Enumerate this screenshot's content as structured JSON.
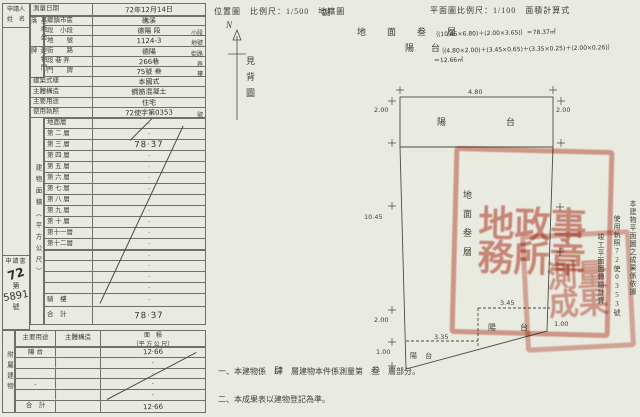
{
  "applicant": {
    "line1": "申請人",
    "line2": "姓　名"
  },
  "application": {
    "doc": "申請書",
    "year": "72",
    "no_prefix": "第",
    "number": "5891",
    "no_suffix": "號"
  },
  "form": {
    "survey": {
      "label": "測量日期",
      "value": "72年12月14日"
    },
    "group_labels": {
      "site": "基地坐落",
      "address": "建物門牌",
      "area": "建物面積（平方公尺）"
    },
    "rows": [
      {
        "label": "鄉鎮市區",
        "value": "礁溪",
        "suffix": ""
      },
      {
        "label": "段　小段",
        "value": "德陽 段",
        "suffix": "小段"
      },
      {
        "label": "地　　號",
        "value": "1124-3",
        "suffix": "地號"
      },
      {
        "label": "街　　路",
        "value": "德陽",
        "suffix": "街路"
      },
      {
        "label": "段 巷 弄",
        "value": "266巷",
        "suffix": "弄"
      },
      {
        "label": "門　　牌",
        "value": "75號 叁",
        "suffix": "樓"
      },
      {
        "label": "建築式樣",
        "value": "本國式",
        "suffix": ""
      },
      {
        "label": "主體構造",
        "value": "鋼筋混凝土",
        "suffix": ""
      },
      {
        "label": "主要用途",
        "value": "住宅",
        "suffix": ""
      },
      {
        "label": "使用執照",
        "value": "72使字第0353",
        "suffix": "號"
      }
    ],
    "floors": [
      {
        "label": "地面層",
        "value": "·"
      },
      {
        "label": "第 二 層",
        "value": "·"
      },
      {
        "label": "第 三 層",
        "value": "78·37",
        "em": true
      },
      {
        "label": "第 四 層",
        "value": "·"
      },
      {
        "label": "第 五 層",
        "value": "·"
      },
      {
        "label": "第 六 層",
        "value": "·"
      },
      {
        "label": "第 七 層",
        "value": "·"
      },
      {
        "label": "第 八 層",
        "value": "·"
      },
      {
        "label": "第 九 層",
        "value": "·"
      },
      {
        "label": "第 十 層",
        "value": "·"
      },
      {
        "label": "第十一層",
        "value": "·"
      },
      {
        "label": "第十二層",
        "value": "·"
      }
    ],
    "extras": [
      "·",
      "·",
      "·",
      "·"
    ],
    "qilou": {
      "label": "騎　樓",
      "value": "·"
    },
    "total": {
      "label": "合　計",
      "value": "78·37"
    }
  },
  "annex": {
    "side_label": "附屬建物",
    "headers": {
      "use": "主要用途",
      "structure": "主體構造",
      "area1": "面　積",
      "area2": "（平 方 公 尺）"
    },
    "rows": [
      {
        "use": "陽 台",
        "structure": "",
        "area": "12·66"
      },
      {
        "use": "",
        "structure": "",
        "area": "·"
      },
      {
        "use": "",
        "structure": "",
        "area": "·"
      },
      {
        "use": "-",
        "structure": "",
        "area": "·"
      },
      {
        "use": "",
        "structure": "",
        "area": "·"
      }
    ],
    "total": {
      "label": "合　計",
      "value": "12·66"
    }
  },
  "location": {
    "caption": "位置圖　比例尺：1/500　地籍圖",
    "north": "N",
    "see_back": "見背圖",
    "note": "說"
  },
  "calc": {
    "caption": "平面圖比例尺：1/100　面積計算式",
    "floor_label": "地　面　叁　層",
    "floor_formula": "｛(10.45×6.80)＋(2.00×3.65)｝＝78.37㎡",
    "balcony_label": "陽　台",
    "balcony_formula": "｛(4.80×2.00)＋(3.45×0.65)＋(3.35×0.25)＋(2.00×0.26)｝",
    "balcony_result": "＝12.66㎡"
  },
  "plan": {
    "balcony_top": "陽　　台",
    "balcony_right": "陽　台",
    "balcony_left": "陽 台",
    "floor_text": "地面叁層",
    "dims": {
      "top": "4.80",
      "left_upper": "2.00",
      "right_upper": "2.00",
      "left_total": "10.45",
      "rb_w": "3.45",
      "rb_h": "1.00",
      "lb_w": "3.35",
      "lb_left": "2.00",
      "lb_h": "1.00"
    }
  },
  "margin_notes": {
    "m1": "本建物平面圖之成果係依據",
    "m2": "使用執照72使0353號",
    "m3": "竣工平面圖轉繪計算"
  },
  "notes": {
    "n1_pre": "一、本建物係",
    "n1_hw1": "肆",
    "n1_mid": "層建物本件係測量第",
    "n1_hw2": "叁",
    "n1_post": "層部分。",
    "n2": "二、本成果表以建物登記為準。"
  },
  "stamp": {
    "chars1": "地政事務所章",
    "chars2": "測量成果"
  }
}
